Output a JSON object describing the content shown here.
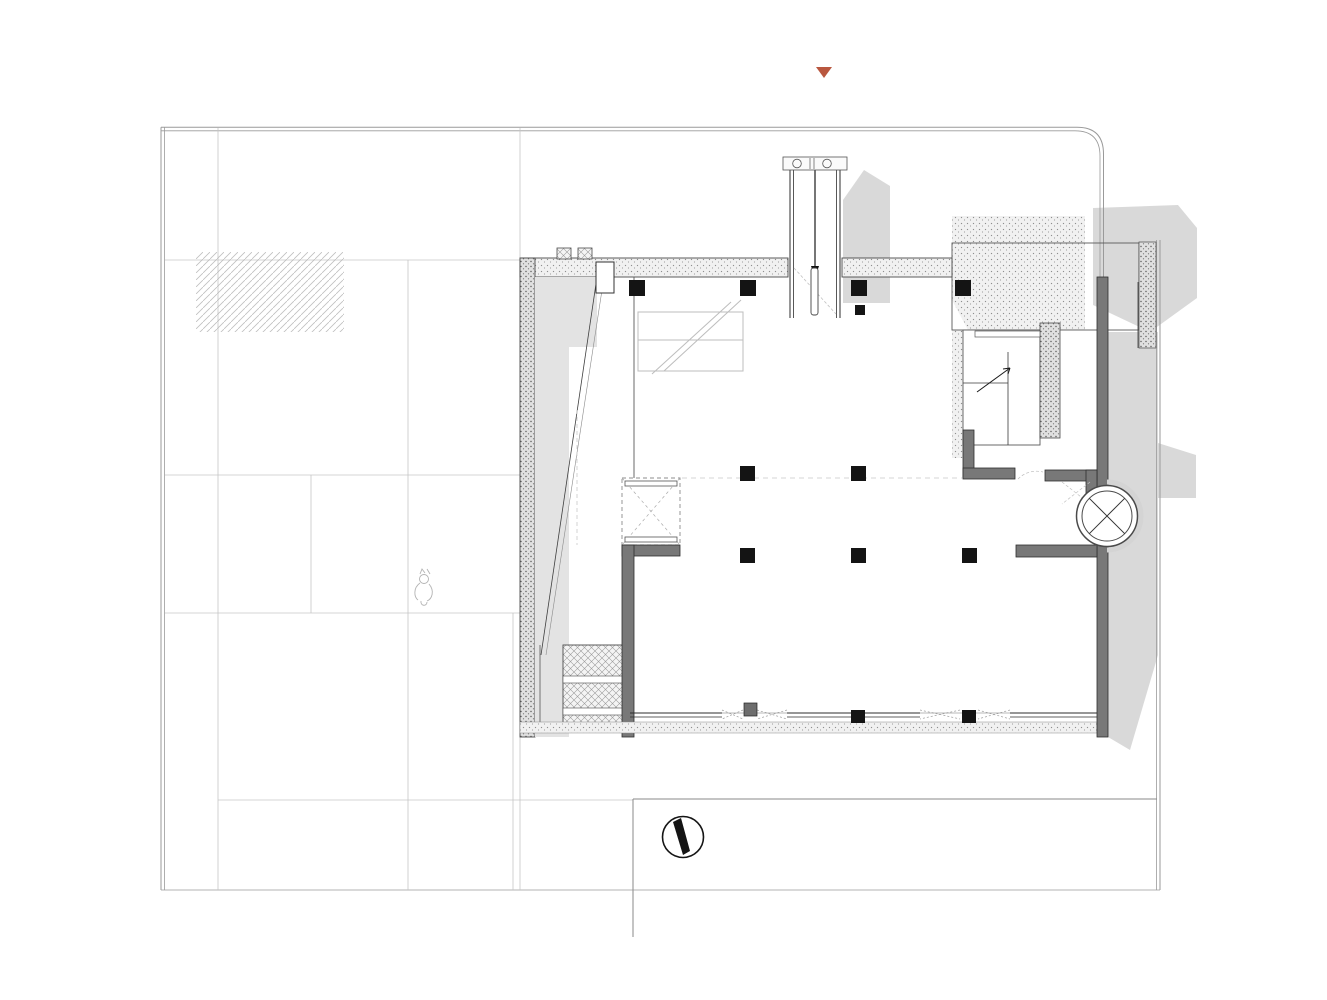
{
  "colors": {
    "accent": "#c05b46",
    "text": "#4a4a4a",
    "wall": "#787878",
    "line": "#9a9a9a",
    "massing": "#d9d9d9"
  },
  "entrance": {
    "en": "Main Entrance",
    "cn": "主入口"
  },
  "roads": {
    "weisan_en": "Weisan Road",
    "weisan_cn": "纬三路",
    "jingyi_en": "Jingyi Road",
    "jingyi_cn": "经一路",
    "jinger_en": "Jinger Road",
    "jinger_cn": "经二路"
  },
  "fire_stairs": {
    "en": "Fire Stairs",
    "cn": "消防楼梯"
  },
  "plan_labels": {
    "n01": "01",
    "n02": "02",
    "n03": "03",
    "n04": "04",
    "n05": "05",
    "n06": "06",
    "n07": "07"
  },
  "title_block": {
    "north": "N",
    "en": "BUILDING PLANS",
    "cn": "建筑平面图"
  },
  "legend": {
    "items": [
      {
        "num": "01.",
        "en": "Events Plaza",
        "cn": "活动广场"
      },
      {
        "num": "02.",
        "en": "Sinking Atrium",
        "cn": "下沉广场"
      },
      {
        "num": "03.",
        "en": "Waterfall",
        "cn": "景观跌水"
      },
      {
        "num": "04.",
        "en": "Alley",
        "cn": "小径"
      },
      {
        "num": "05.",
        "en": "Elevator",
        "cn": "圆形电梯"
      },
      {
        "num": "06.",
        "en": "Leisure Booth",
        "cn": "休闲卡座"
      },
      {
        "num": "07.",
        "en": "Landscape",
        "cn": "干景"
      }
    ]
  }
}
